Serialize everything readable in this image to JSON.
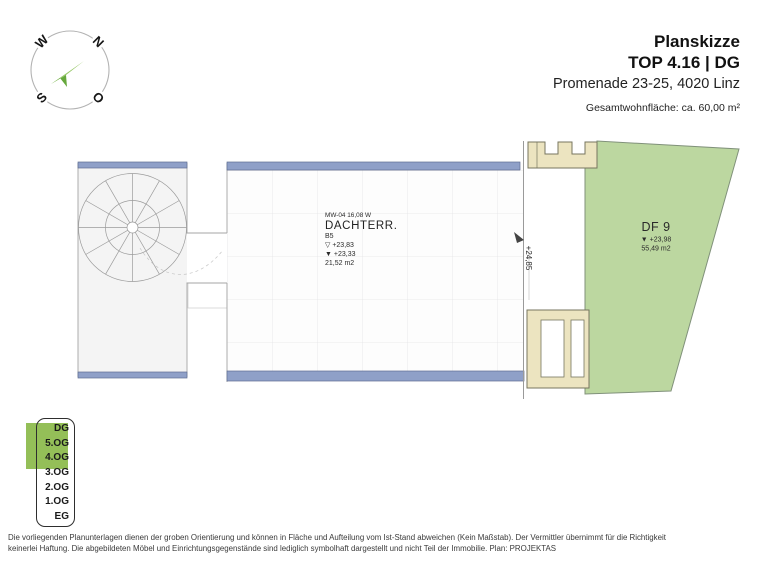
{
  "header": {
    "title": "Planskizze",
    "unit_line": "TOP 4.16  |  DG",
    "address": "Promenade 23-25, 4020 Linz",
    "area_note": "Gesamtwohnfläche: ca. 60,00 m²"
  },
  "compass": {
    "west": "W",
    "north": "N",
    "south": "S",
    "east": "O"
  },
  "plan": {
    "terrace": {
      "wall_code": "MW-04 16,08 W",
      "room_name": "DACHTERR.",
      "room_code": "B5",
      "level_top": "▽ +23,83",
      "level_bottom": "▼ +23,33",
      "area": "21,52 m2"
    },
    "roof_area": {
      "name": "DF 9",
      "level": "▼ +23,98",
      "area": "55,49 m2"
    },
    "dimension_right": "+24,85"
  },
  "legend": {
    "floors": [
      "DG",
      "5.OG",
      "4.OG",
      "3.OG",
      "2.OG",
      "1.OG",
      "EG"
    ],
    "highlighted_floors": [
      "DG",
      "5.OG",
      "4.OG"
    ]
  },
  "footer": {
    "line1": "Die vorliegenden Planunterlagen dienen der groben Orientierung und können in Fläche und Aufteilung vom Ist-Stand abweichen (Kein Maßstab). Der Vermittler übernimmt für die Richtigkeit",
    "line2": "keinerlei Haftung. Die abgebildeten Möbel und Einrichtungsgegenstände sind lediglich symbolhaft dargestellt und nicht Teil der Immobilie. Plan: PROJEKTAS"
  },
  "colors": {
    "wall_blue": "#8fa0c8",
    "roof_green": "#bcd7a0",
    "legend_green": "#94bf58",
    "beige": "#ece4c0",
    "compass_arrow": "#7ab648"
  }
}
